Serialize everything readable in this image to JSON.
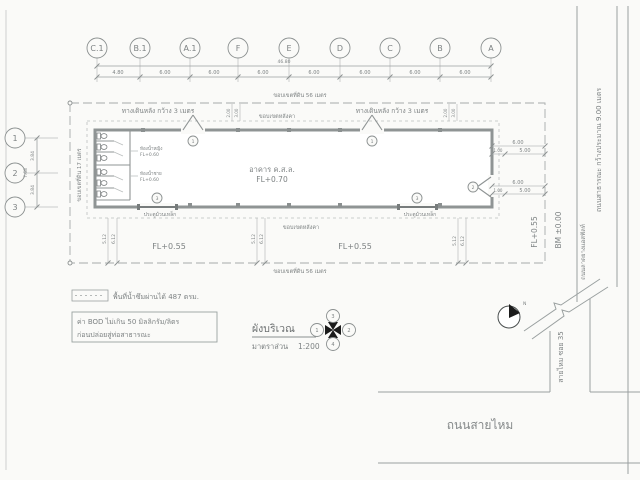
{
  "drawing_title": {
    "title": "ผังบริเวณ",
    "scale_label": "มาตราส่วน",
    "scale_value": "1:200"
  },
  "grid": {
    "cols": [
      "C.1",
      "B.1",
      "A.1",
      "F",
      "E",
      "D",
      "C",
      "B",
      "A"
    ],
    "col_dims": [
      "4.80",
      "6.00",
      "6.00",
      "6.00",
      "6.00",
      "6.00",
      "6.00",
      "6.00"
    ],
    "total_width": "46.80",
    "rows": [
      "1",
      "2",
      "3"
    ],
    "row_dims": [
      "3.84",
      "3.84"
    ],
    "total_height": "7.68"
  },
  "site": {
    "boundary_top": "ขอบเขตที่ดิน 56 เมตร",
    "boundary_bottom": "ขอบเขตที่ดิน 56 เมตร",
    "boundary_left": "ขอบเขตที่ดิน 17 เมตร",
    "roof_edge_top": "ขอบเขตหลังคา",
    "roof_edge_bottom": "ขอบเขตหลังคา",
    "walkway_left": "ทางเดินหลัง กว้าง 3 เมตร",
    "walkway_right": "ทางเดินหลัง กว้าง 3 เมตร",
    "yard_level_left": "FL+0.55",
    "yard_level_right": "FL+0.55",
    "side_level": "FL+0.55",
    "benchmark": "BM ±0.00"
  },
  "building": {
    "label": "อาคาร ค.ส.ล.",
    "level": "FL+0.70",
    "female_toilet": "ห้องน้ำหญิง",
    "female_toilet_level": "FL+0.60",
    "male_toilet": "ห้องน้ำชาย",
    "male_toilet_level": "FL+0.60",
    "roller_door_left": "ประตูม้วนเหล็ก",
    "roller_door_right": "ประตูม้วนเหล็ก"
  },
  "markers": {
    "top_door": "1",
    "bottom_door": "3",
    "right_door": "2",
    "north_letter": "N",
    "key_top": "3",
    "key_right": "2",
    "key_bottom": "4",
    "key_left": "1"
  },
  "dims": {
    "yard": [
      "5.12",
      "6.12"
    ],
    "right_top": [
      "6.00",
      "1.00",
      "5.00"
    ],
    "right_mid": [
      "6.00",
      "1.00",
      "5.00"
    ],
    "walk": [
      "2.00",
      "3.00"
    ]
  },
  "roads": {
    "public_road": "ถนนสาธารณะ กว้างประมาณ 9.00 เมตร",
    "asphalt_road": "ถนนลาดยางแอสฟัลท์",
    "soi": "สายไหม ซอย 35",
    "main_road": "ถนนสายไหม"
  },
  "legend": {
    "permeable_area": "พื้นที่น้ำซึมผ่านได้ 487 ตรม.",
    "bod_line1": "ค่า BOD ไม่เกิน 50 มิลลิกรัม/ลิตร",
    "bod_line2": "ก่อนปล่อยสู่ท่อสาธารณะ"
  },
  "colors": {
    "paper": "#fafaf8",
    "line_gray": "#9aa0a0",
    "text_gray": "#7d8283",
    "ink_black": "#1b1b1b"
  }
}
